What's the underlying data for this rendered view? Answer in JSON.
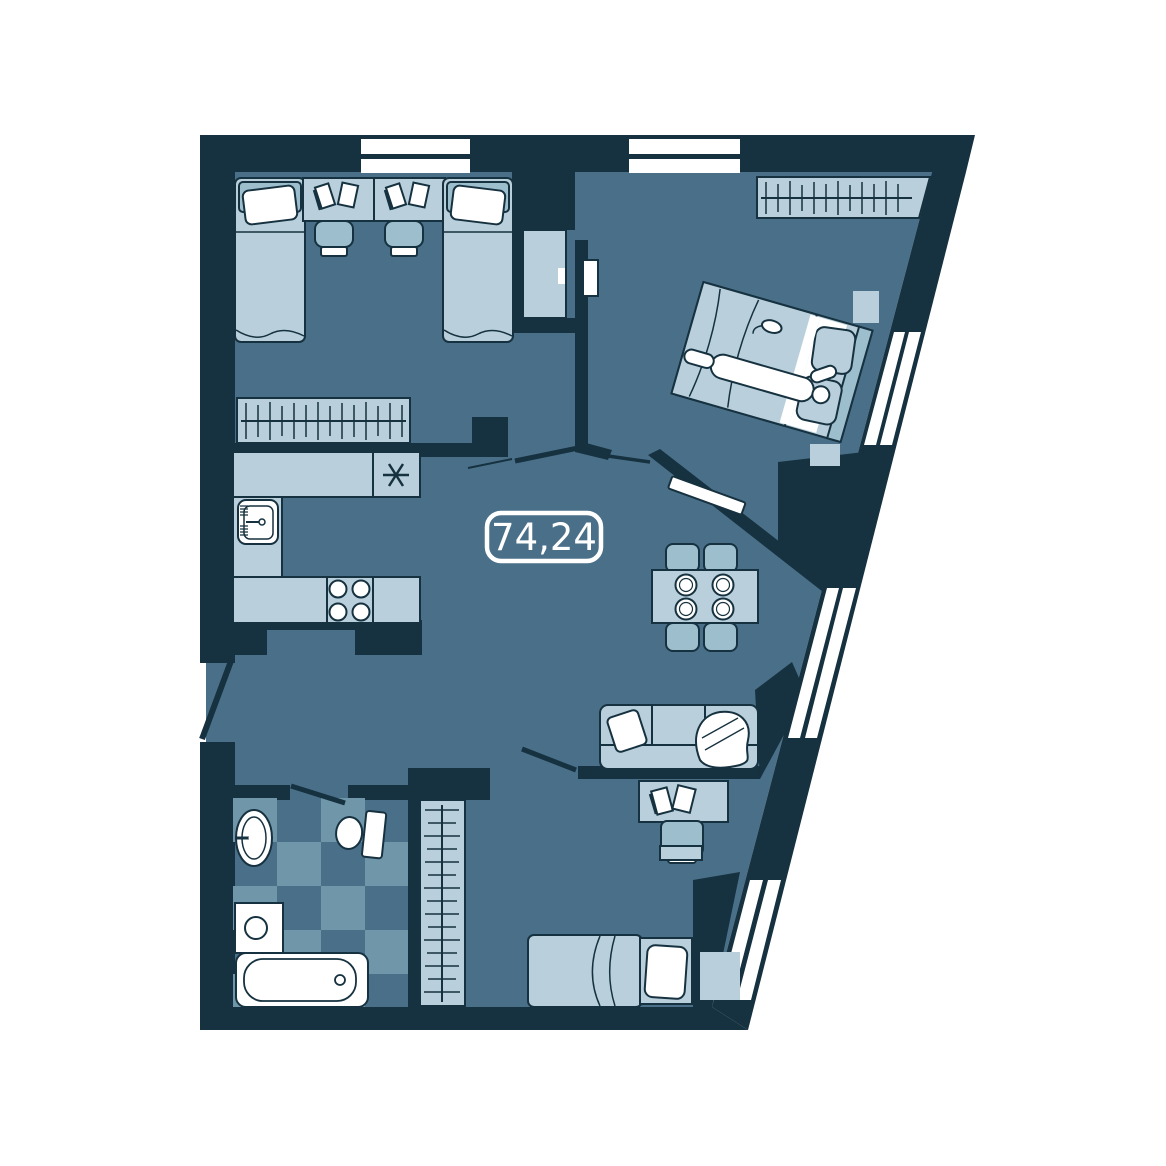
{
  "page": {
    "background": "#ffffff"
  },
  "area_label": {
    "value": "74,24"
  },
  "theme": {
    "wall": "#16313f",
    "floor": "#4a7089",
    "furn": "#b9d0dc",
    "furnMid": "#9dbecd",
    "tile": "#6f97a9",
    "paper": "#ffffff",
    "labelColor": "#ffffff"
  },
  "icons": {
    "fridge-icon": "six-spoke asterisk",
    "stove-icon": "four burner circles",
    "hanger-icon": "rail with hanger ticks",
    "sink-icon": "basin with faucet",
    "bathtub-icon": "rounded tub with drain",
    "toilet-icon": "bowl with tank",
    "washer-icon": "square with round door"
  }
}
